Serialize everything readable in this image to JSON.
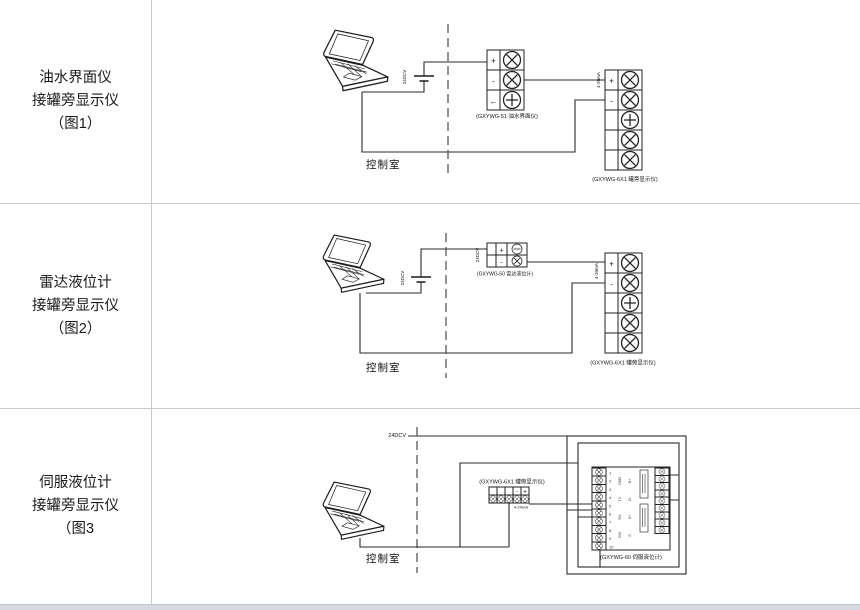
{
  "window": {
    "background": "#ffffff",
    "grid_line_color": "#c9c9c9",
    "footer_strip_color": "#d7dade"
  },
  "rows": [
    {
      "title_lines": [
        "油水界面仪",
        "接罐旁显示仪",
        "（图1）"
      ],
      "diagram": {
        "control_room": "控制室",
        "battery_voltage": "24DCV",
        "signal_range": "4-20mA",
        "transmitter_caption": "(GXYWG-51 油水界面仪)",
        "display_caption": "(GXYWG-6X1 罐旁显示仪)",
        "transmitter_terminals": [
          "+",
          "-",
          "←"
        ],
        "display_terminals": [
          "+",
          "-"
        ]
      }
    },
    {
      "title_lines": [
        "雷达液位计",
        "接罐旁显示仪",
        "（图2）"
      ],
      "diagram": {
        "control_room": "控制室",
        "battery_voltage": "24DCV",
        "block_voltage": "24DCV",
        "signal_range": "4-20mA",
        "transmitter_caption": "(GXYWG-50 雷达液位计)",
        "display_caption": "(GXYWG-6X1 罐旁显示仪)",
        "transmitter_terminals": [
          "+",
          "-"
        ],
        "display_terminals": [
          "+",
          "-"
        ]
      }
    },
    {
      "title_lines": [
        "伺服液位计",
        "接罐旁显示仪",
        "（图3"
      ],
      "diagram": {
        "control_room": "控制室",
        "supply_voltage": "24DCV",
        "signal_range": "4-20mA",
        "display_caption": "(GXYWG-6X1 罐旁显示仪)",
        "display_terminals": [
          "-",
          "+"
        ],
        "servo_caption": "(GXYWG-60 伺服液位计)",
        "servo_pins": [
          "1",
          "2",
          "3",
          "4",
          "5",
          "6",
          "7",
          "8",
          "9",
          "10"
        ],
        "servo_labels_a": [
          "GND",
          "TX",
          "RX",
          "24V"
        ],
        "servo_labels_b": [
          "D+",
          "D-",
          "S+",
          "S-"
        ]
      }
    }
  ]
}
